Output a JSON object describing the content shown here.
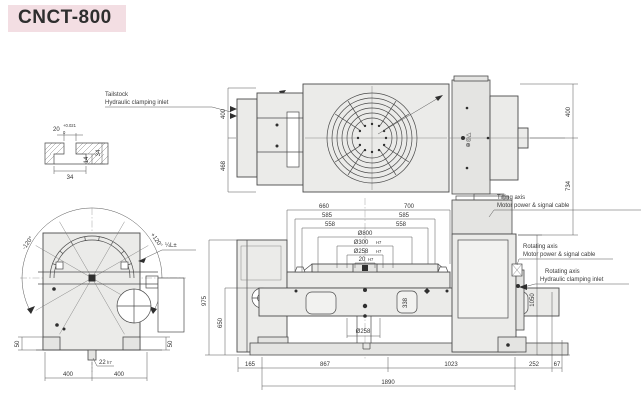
{
  "title": "CNCT-800",
  "colors": {
    "accent_bg": "#f3dee3",
    "line": "#4a4a4a",
    "body_fill": "#ebebe9"
  },
  "tslot_detail": {
    "nominal": "20",
    "tol_upper": "+0.021",
    "tol_lower": "0",
    "bottom_width": "34",
    "inner_height": "14",
    "outer_height": "34"
  },
  "callouts": {
    "tailstock": {
      "line1": "Tailstock",
      "line2": "Hydraulic clamping inlet"
    },
    "tilting_axis": {
      "line1": "Tilting axis",
      "line2": "Motor power & signal cable"
    },
    "rotating_axis_cable": {
      "line1": "Rotating axis",
      "line2": "Motor power & signal cable"
    },
    "rotating_axis_inlet": {
      "line1": "Rotating axis",
      "line2": "Hydraulic clamping inlet"
    }
  },
  "top_view": {
    "left_upper": "400",
    "left_lower": "468",
    "right_upper": "400",
    "right_lower": "734",
    "motor_marks": "⊕◎△"
  },
  "front_view": {
    "width_left": "660",
    "width_right": "700",
    "half_left": "585",
    "half_right": "585",
    "slot_left": "558",
    "slot_right": "558",
    "table_dia": "Ø800",
    "bore_dia": "Ø300",
    "bore_fit": "H7",
    "spigot_dia": "Ø258",
    "spigot_fit": "H7",
    "key_width": "20",
    "key_fit": "H7",
    "height_table": "975",
    "height_base": "650",
    "pocket_height": "338",
    "bottom_dia": "Ø258",
    "height_right": "1050",
    "base_left": "165",
    "base_mid": "867",
    "base_right": "1023",
    "overhang": "252",
    "edge": "67",
    "total_length": "1890"
  },
  "side_view": {
    "tilt_minus": "-120°",
    "tilt_plus": "+120°",
    "note": "¼L±",
    "foot_left": "50",
    "foot_right": "50",
    "key": "22",
    "key_fit": "h7",
    "span_left": "400",
    "span_right": "400"
  }
}
